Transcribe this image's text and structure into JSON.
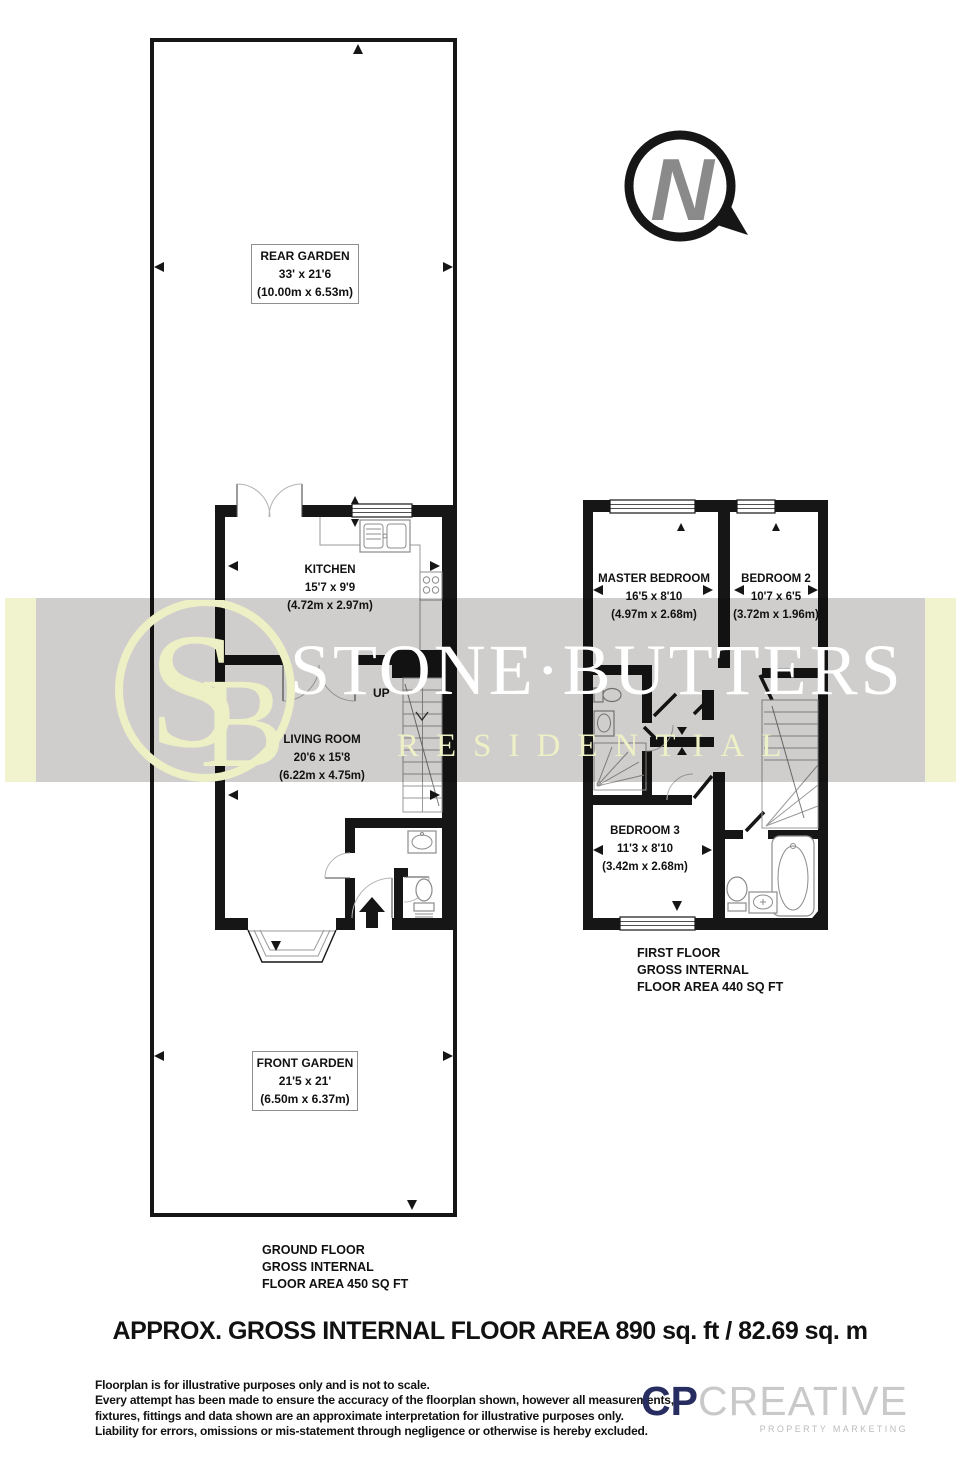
{
  "north": {
    "letter": "N"
  },
  "watermark": {
    "monogram_s": "S",
    "monogram_b": "B",
    "name": "STONE·BUTTERS",
    "subtitle": "RESIDENTIAL",
    "band_gray_color": "#d5d4d2",
    "accent_color": "#eef0c6"
  },
  "ground_floor": {
    "rear_garden": {
      "name": "REAR GARDEN",
      "imperial": "33' x 21'6",
      "metric": "(10.00m x 6.53m)"
    },
    "kitchen": {
      "name": "KITCHEN",
      "imperial": "15'7 x 9'9",
      "metric": "(4.72m x 2.97m)"
    },
    "living_room": {
      "name": "LIVING ROOM",
      "imperial": "20'6 x 15'8",
      "metric": "(6.22m x 4.75m)"
    },
    "up_label": "UP",
    "front_garden": {
      "name": "FRONT GARDEN",
      "imperial": "21'5 x 21'",
      "metric": "(6.50m x 6.37m)"
    },
    "caption": {
      "line1": "GROUND FLOOR",
      "line2": "GROSS INTERNAL",
      "line3": "FLOOR AREA 450 SQ FT"
    }
  },
  "first_floor": {
    "master_bedroom": {
      "name": "MASTER BEDROOM",
      "imperial": "16'5 x 8'10",
      "metric": "(4.97m x 2.68m)"
    },
    "bedroom_2": {
      "name": "BEDROOM 2",
      "imperial": "10'7 x 6'5",
      "metric": "(3.72m x 1.96m)"
    },
    "bedroom_3": {
      "name": "BEDROOM 3",
      "imperial": "11'3 x 8'10",
      "metric": "(3.42m x 2.68m)"
    },
    "caption": {
      "line1": "FIRST FLOOR",
      "line2": "GROSS INTERNAL",
      "line3": "FLOOR AREA 440 SQ FT"
    }
  },
  "footer": {
    "area_summary": "APPROX. GROSS INTERNAL FLOOR AREA 890 sq. ft / 82.69 sq. m",
    "disclaimer": {
      "line1": "Floorplan is for illustrative purposes only and is not to scale.",
      "line2": "Every attempt has been made to ensure the accuracy of the floorplan shown, however all measurements,",
      "line3": "fixtures, fittings and data shown are an approximate interpretation for illustrative purposes only.",
      "line4": "Liability for errors, omissions or mis-statement through negligence or otherwise is hereby excluded."
    },
    "logo": {
      "prefix": "CP",
      "suffix": "CREATIVE",
      "tagline": "PROPERTY MARKETING",
      "prefix_color": "#272d60",
      "suffix_color": "#c9c9c9"
    }
  }
}
